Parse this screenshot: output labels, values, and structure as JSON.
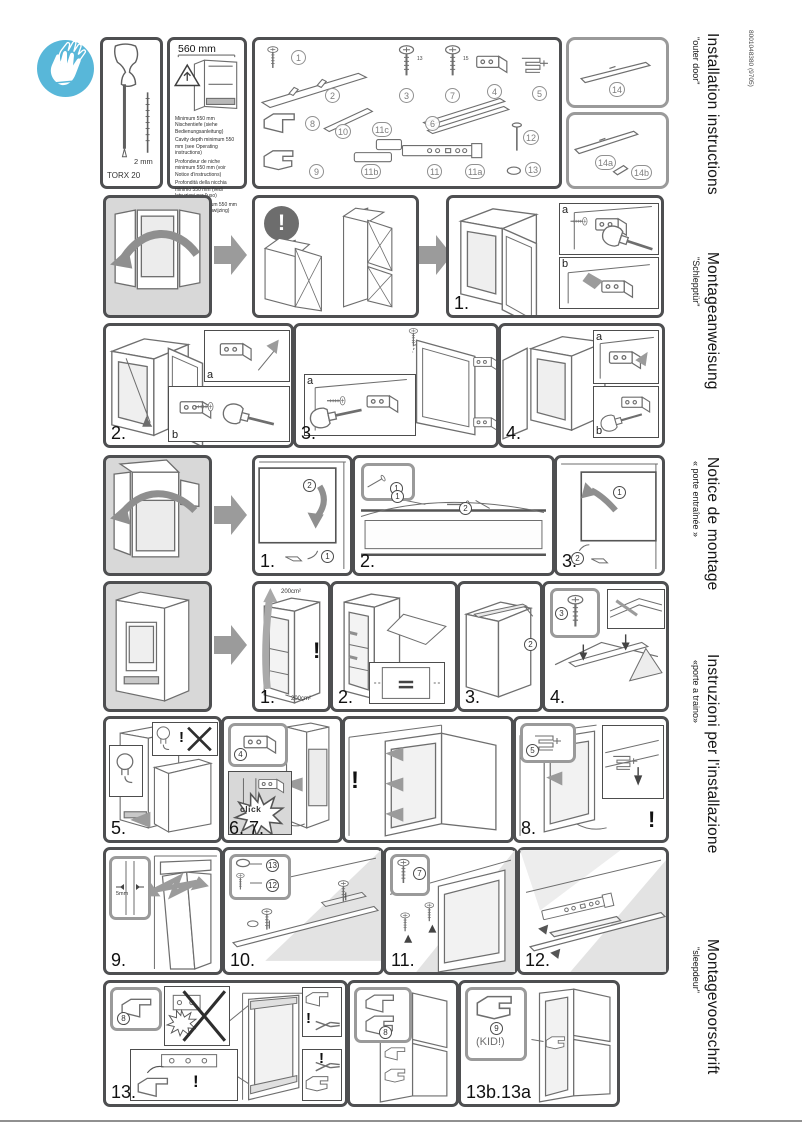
{
  "doc": {
    "number": "8001048380 (9705)",
    "languages": [
      {
        "title": "Installation instructions",
        "subtitle": "\"outer door\""
      },
      {
        "title": "Montageanweisung",
        "subtitle": "\"Schlepptür\""
      },
      {
        "title": "Notice de montage",
        "subtitle": "« porte entraînée »"
      },
      {
        "title": "Instruzioni per l'installazione",
        "subtitle": "«porte a traino»"
      },
      {
        "title": "Montagevoorschrift",
        "subtitle": "\"sleepdeur\""
      }
    ]
  },
  "colors": {
    "accent_blue": "#58b7d9",
    "panel_border": "#4e4f51",
    "ref_border": "#9a9a9a",
    "arrow_gray": "#9b9b9b",
    "intro_bg": "#d8d8d8"
  },
  "tools": {
    "screwdriver": "TORX 20",
    "bit": "2 mm"
  },
  "cavity": {
    "dimension": "560 mm",
    "notes": [
      "Minimum 550 mm Nischentiefe (siehe Bedienungsanleitung)",
      "Cavity depth minimum 550 mm (see Operating instructions)",
      "Profondeur de niche minimum 550 mm (voir Notice d'instructions)",
      "Profondità della nicchia minimo 550 mm (vedi Istruzioni per l'uso)",
      "Nisdiepte minimum 550 mm (zie Gebruiksaanwijzing)"
    ]
  },
  "parts": {
    "n1": "1",
    "n2": "2",
    "n3": "3",
    "n4": "4",
    "n5": "5",
    "n6": "6",
    "n7": "7",
    "n8": "8",
    "n9": "9",
    "n10": "10",
    "n11": "11",
    "n11a": "11a",
    "n11b": "11b",
    "n11c": "11c",
    "n12": "12",
    "n13": "13",
    "n14": "14",
    "n14a": "14a",
    "n14b": "14b",
    "screw3_len": "13",
    "screw7_len": "15"
  },
  "steps": {
    "r1s1": "1.",
    "r2s2": "2.",
    "r2s3": "3.",
    "r2s4": "4.",
    "r3s1": "1.",
    "r3s2": "2.",
    "r3s3": "3.",
    "r4s1": "1.",
    "r4s2": "2.",
    "r4s3": "3.",
    "r4s4": "4.",
    "s5": "5.",
    "s67": "6. 7.",
    "s8": "8.",
    "s9": "9.",
    "s10": "10.",
    "s11": "11.",
    "s12": "12.",
    "s13": "13.",
    "s13b": "13b.13a"
  },
  "markers": {
    "m1": "1",
    "m2": "2",
    "m3": "3",
    "m4": "4",
    "m5": "5",
    "m7": "7",
    "m8": "8",
    "m9": "9",
    "m12": "12",
    "m13": "13"
  },
  "letters": {
    "a": "a",
    "b": "b"
  },
  "labels": {
    "exclamation": "!",
    "click": "click",
    "kid": "(KID!)",
    "gap": "5mm",
    "vent_top": "200cm²",
    "vent_bottom": "200cm²"
  }
}
